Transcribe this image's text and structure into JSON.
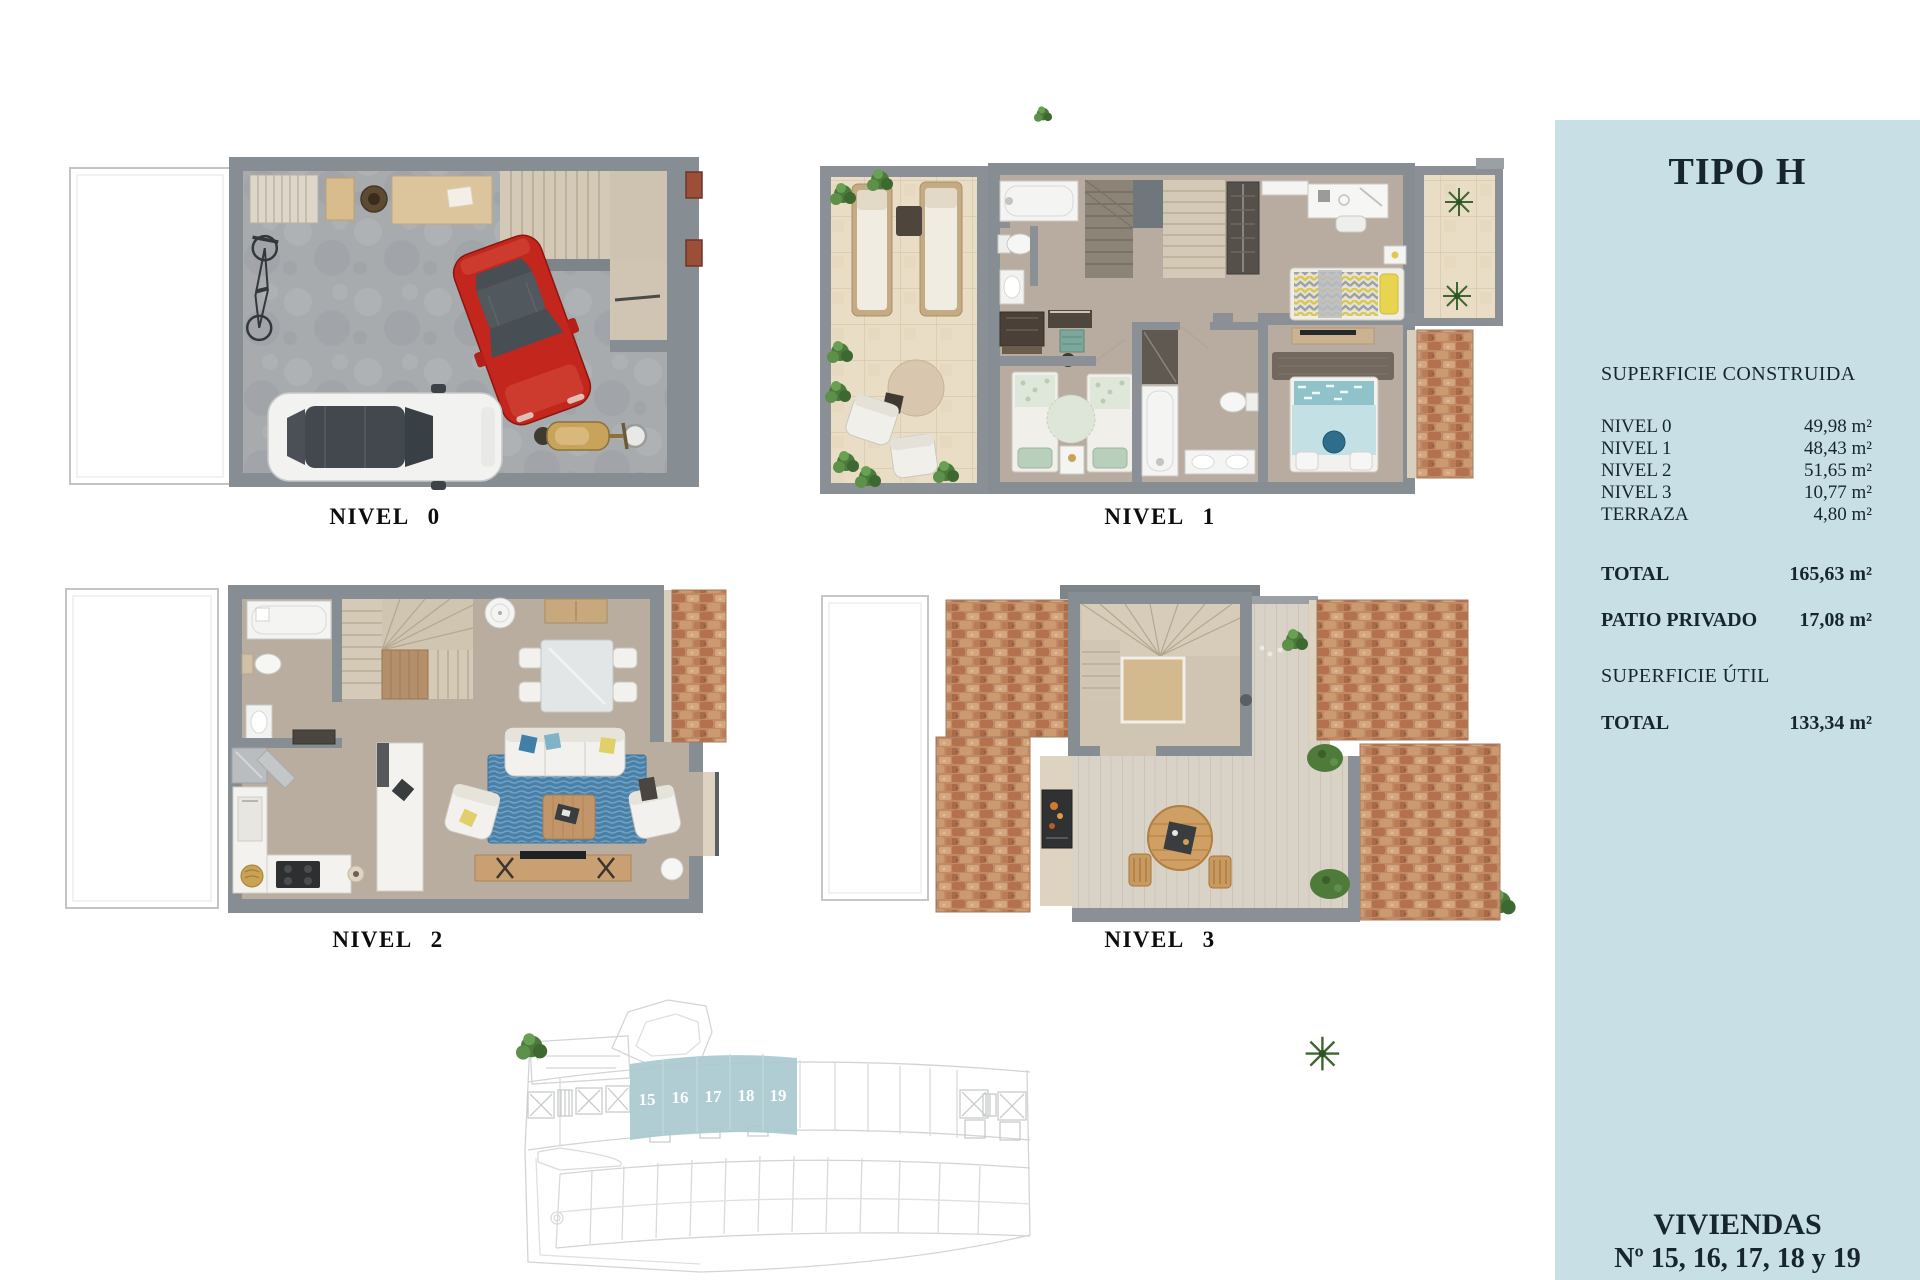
{
  "page": {
    "background": "#ffffff"
  },
  "plans": {
    "nivel0": {
      "label": "NIVEL 0"
    },
    "nivel1": {
      "label": "NIVEL 1"
    },
    "nivel2": {
      "label": "NIVEL 2"
    },
    "nivel3": {
      "label": "NIVEL 3"
    }
  },
  "sidebar": {
    "background_color": "#c9dfe6",
    "text_color": "#17262e",
    "title": "TIPO H",
    "construida_heading": "SUPERFICIE CONSTRUIDA",
    "construida_rows": [
      {
        "label": "NIVEL 0",
        "value": "49,98 m²"
      },
      {
        "label": "NIVEL 1",
        "value": "48,43 m²"
      },
      {
        "label": "NIVEL 2",
        "value": "51,65 m²"
      },
      {
        "label": "NIVEL 3",
        "value": "10,77 m²"
      },
      {
        "label": "TERRAZA",
        "value": "4,80 m²"
      }
    ],
    "total_row": {
      "label": "TOTAL",
      "value": "165,63 m²"
    },
    "patio_row": {
      "label": "PATIO PRIVADO",
      "value": "17,08 m²"
    },
    "util_heading": "SUPERFICIE ÚTIL",
    "util_total_row": {
      "label": "TOTAL",
      "value": "133,34 m²"
    },
    "footer_line1": "VIVIENDAS",
    "footer_line2": "Nº 15, 16, 17, 18 y 19"
  },
  "siteplan": {
    "highlight_color": "#a9c9d0",
    "units": [
      "15",
      "16",
      "17",
      "18",
      "19"
    ]
  },
  "colors": {
    "wall_gray": "#868d93",
    "concrete": "#a7abae",
    "interior_floor": "#b7ac9f",
    "terrace_tile": "#e9ddc5",
    "brick": "#c08a67",
    "stair_beige": "#d3c9b6",
    "rug_blue": "#4a80a8",
    "car_red": "#c3261c"
  }
}
